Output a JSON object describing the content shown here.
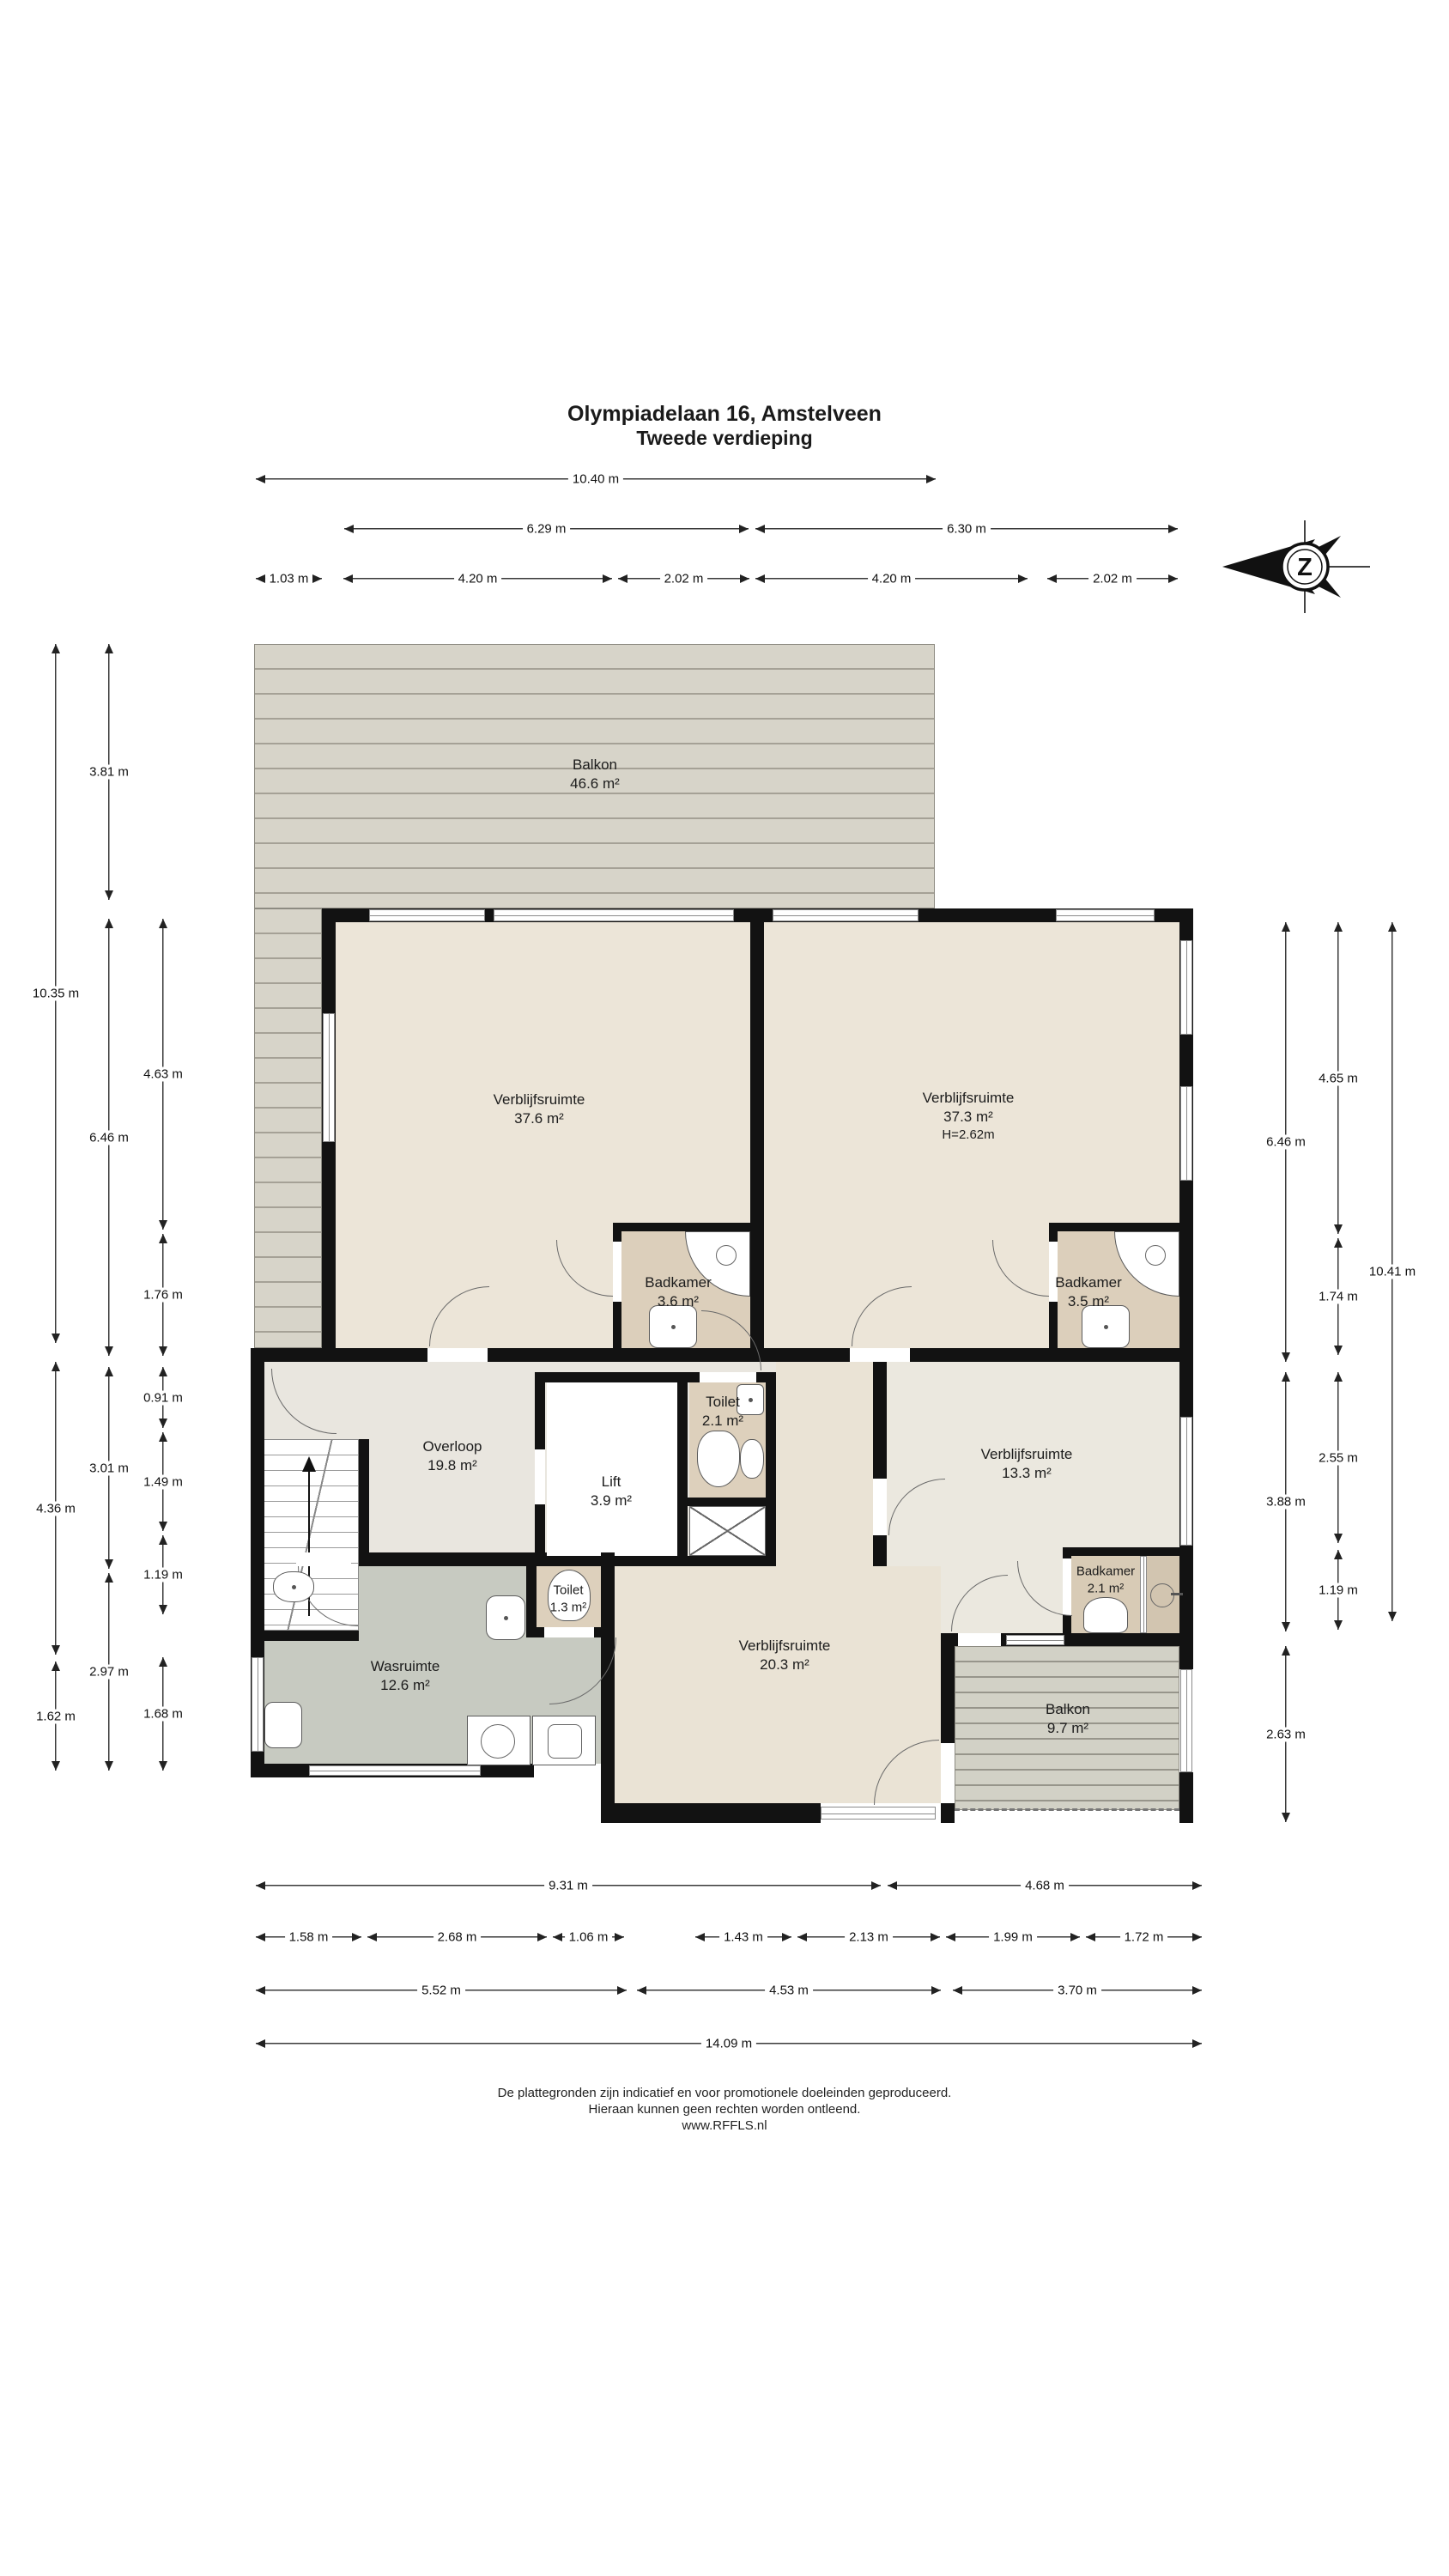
{
  "title": {
    "line1": "Olympiadelaan 16, Amstelveen",
    "line2": "Tweede verdieping"
  },
  "compass": {
    "letter": "Z"
  },
  "rooms": {
    "balkon_top": {
      "name": "Balkon",
      "area": "46.6 m²"
    },
    "verblijf_links": {
      "name": "Verblijfsruimte",
      "area": "37.6 m²"
    },
    "verblijf_rechts": {
      "name": "Verblijfsruimte",
      "area": "37.3 m²",
      "height": "H=2.62m"
    },
    "badkamer_links": {
      "name": "Badkamer",
      "area": "3.6 m²"
    },
    "badkamer_rechts": {
      "name": "Badkamer",
      "area": "3.5 m²"
    },
    "overloop": {
      "name": "Overloop",
      "area": "19.8 m²"
    },
    "lift": {
      "name": "Lift",
      "area": "3.9 m²"
    },
    "toilet_boven": {
      "name": "Toilet",
      "area": "2.1 m²"
    },
    "verblijf_midden": {
      "name": "Verblijfsruimte",
      "area": "13.3 m²"
    },
    "badkamer_klein": {
      "name": "Badkamer",
      "area": "2.1 m²"
    },
    "toilet_onder": {
      "name": "Toilet",
      "area": "1.3 m²"
    },
    "wasruimte": {
      "name": "Wasruimte",
      "area": "12.6 m²"
    },
    "verblijf_onder": {
      "name": "Verblijfsruimte",
      "area": "20.3 m²"
    },
    "balkon_onder": {
      "name": "Balkon",
      "area": "9.7 m²"
    }
  },
  "dims": {
    "top": {
      "r1": [
        "10.40 m"
      ],
      "r2": [
        "6.29 m",
        "6.30 m"
      ],
      "r3": [
        "1.03 m",
        "4.20 m",
        "2.02 m",
        "4.20 m",
        "2.02 m"
      ]
    },
    "left": {
      "c1": [
        "10.35 m",
        "4.36 m",
        "1.62 m"
      ],
      "c2": [
        "3.81 m",
        "6.46 m",
        "3.01 m",
        "2.97 m"
      ],
      "c3": [
        "4.63 m",
        "1.76 m",
        "0.91 m",
        "1.49 m",
        "1.19 m",
        "1.68 m"
      ]
    },
    "right": {
      "c1": [
        "6.46 m",
        "3.88 m",
        "2.63 m"
      ],
      "c2": [
        "4.65 m",
        "1.74 m",
        "2.55 m",
        "1.19 m"
      ],
      "c3": [
        "10.41 m"
      ]
    },
    "bottom": {
      "r1": [
        "9.31 m",
        "4.68 m"
      ],
      "r2": [
        "1.58 m",
        "2.68 m",
        "1.06 m",
        "1.43 m",
        "2.13 m",
        "1.99 m",
        "1.72 m"
      ],
      "r3": [
        "5.52 m",
        "4.53 m",
        "3.70 m"
      ],
      "r4": [
        "14.09 m"
      ]
    }
  },
  "footer": {
    "line1": "De plattegronden zijn indicatief en voor promotionele doeleinden geproduceerd.",
    "line2": "Hieraan kunnen geen rechten worden ontleend.",
    "line3": "www.RFFLS.nl"
  },
  "colors": {
    "wall": "#121212",
    "floor_cream": "#ece5d8",
    "floor_hall": "#e9e6df",
    "floor_gray": "#c7cac1",
    "floor_bath": "#dccfbb",
    "deck": "#d7d4c9",
    "dim_line": "#3a3a3a"
  }
}
